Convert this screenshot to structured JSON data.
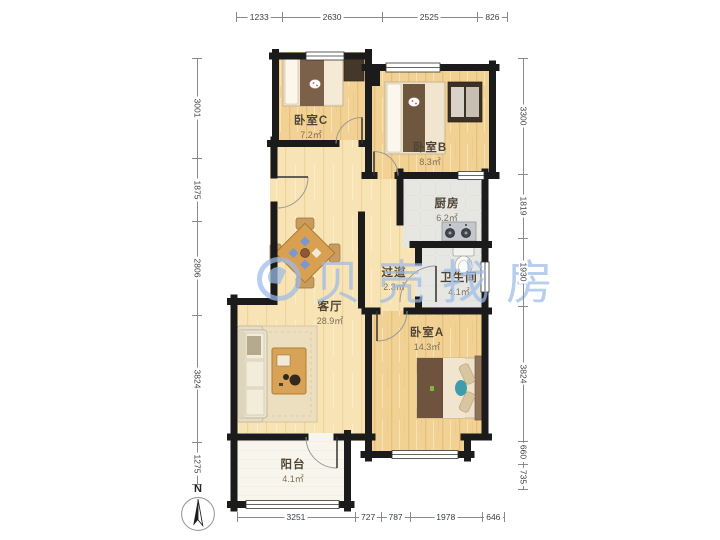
{
  "watermark": {
    "brand": "贝壳找房",
    "color": "#9dbce8"
  },
  "compass": {
    "label": "N"
  },
  "rooms": {
    "bedroomC": {
      "name": "卧室C",
      "area": "7.2㎡"
    },
    "bedroomB": {
      "name": "卧室B",
      "area": "8.3㎡"
    },
    "kitchen": {
      "name": "厨房",
      "area": "6.2㎡"
    },
    "hallway": {
      "name": "过道",
      "area": "2.3㎡"
    },
    "bathroom": {
      "name": "卫生间",
      "area": "4.1㎡"
    },
    "living": {
      "name": "客厅",
      "area": "28.9㎡"
    },
    "bedroomA": {
      "name": "卧室A",
      "area": "14.3㎡"
    },
    "balcony": {
      "name": "阳台",
      "area": "4.1㎡"
    }
  },
  "dimensions": {
    "top": [
      {
        "label": "1233",
        "mm": 1233
      },
      {
        "label": "2630",
        "mm": 2630
      },
      {
        "label": "2525",
        "mm": 2525
      },
      {
        "label": "826",
        "mm": 826
      }
    ],
    "bottom": [
      {
        "label": "3251",
        "mm": 3251
      },
      {
        "label": "727",
        "mm": 727
      },
      {
        "label": "787",
        "mm": 787
      },
      {
        "label": "1978",
        "mm": 1978
      },
      {
        "label": "646",
        "mm": 646
      }
    ],
    "left": [
      {
        "label": "3001",
        "mm": 3001
      },
      {
        "label": "1875",
        "mm": 1875
      },
      {
        "label": "2806",
        "mm": 2806
      },
      {
        "label": "3824",
        "mm": 3824
      },
      {
        "label": "1275",
        "mm": 1275
      }
    ],
    "right": [
      {
        "label": "3300",
        "mm": 3300
      },
      {
        "label": "1819",
        "mm": 1819
      },
      {
        "label": "1930",
        "mm": 1930
      },
      {
        "label": "3824",
        "mm": 3824
      },
      {
        "label": "660",
        "mm": 660
      },
      {
        "label": "735",
        "mm": 735
      }
    ]
  },
  "colors": {
    "wall": "#1b1b1b",
    "wood_bedroom": "#f2d194",
    "wood_living": "#f7e3b4",
    "tile": "#e6e6e2",
    "balcony_floor": "#f8f6ec",
    "watermark_blue": "#9dbce8"
  }
}
